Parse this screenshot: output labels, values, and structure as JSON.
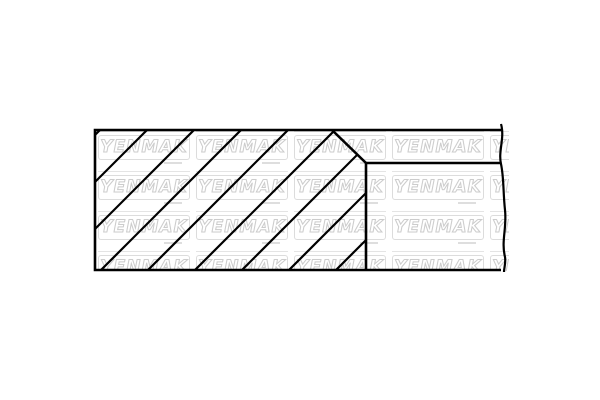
{
  "watermark": {
    "text": "YENMAK",
    "text_fill": "#ffffff",
    "text_outline_color": "#cccccc",
    "rule_line_color": "#e4e4e4",
    "box_border_color": "#dcdcdc",
    "sub_dash_color": "#dedede",
    "grid": {
      "rows": 4,
      "cols": 5,
      "tile_width": 98,
      "tile_height": 40
    },
    "area": {
      "left": 95,
      "top": 130,
      "width": 414,
      "height": 141
    }
  },
  "diagram": {
    "description": "piston-ring-cross-section",
    "background": "#ffffff",
    "stroke_color": "#000000",
    "outline_stroke_width": 2.6,
    "hatch_stroke_width": 2.2,
    "canvas": {
      "width": 600,
      "height": 400
    },
    "outline_path": "M 501 130 L 95 130 L 95 270 L 501 270",
    "break_edge_path": "M 501 124 C 505 138 498 151 501 164 C 504 178 503 192 505 210 C 507 228 501 241 505 257 C 506 263 504 268 504 272",
    "step_horizontal_line": {
      "x1": 366,
      "y1": 163,
      "x2": 501,
      "y2": 163
    },
    "step_vertical_line": {
      "x1": 366,
      "y1": 163,
      "x2": 366,
      "y2": 270
    },
    "chamfer_line": {
      "x1": 332,
      "y1": 130,
      "x2": 366,
      "y2": 163
    },
    "hatch": {
      "clip_polygon": "95,130 332,130 366,163 366,270 95,270",
      "angle_deg": 45,
      "bottom_intercepts_x": [
        -40,
        7,
        54,
        101,
        148,
        195,
        242,
        289,
        336
      ],
      "bottom_y": 270
    }
  }
}
